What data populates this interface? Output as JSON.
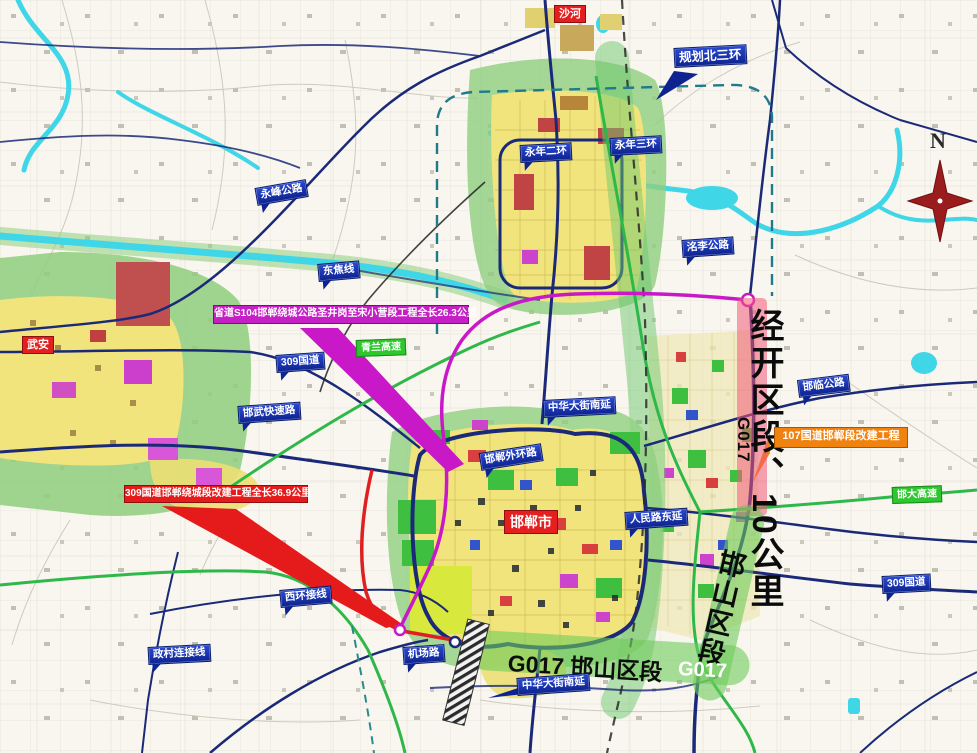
{
  "map": {
    "city_labels": {
      "shahe": "沙河",
      "wuan": "武安",
      "handan": "邯郸市"
    },
    "road_labels": {
      "yongfeng": "永峰公路",
      "dongjiao": "东焦线",
      "g309_west": "309国道",
      "hanwu": "邯武快速路",
      "mingli": "洺李公路",
      "yongnian_2nd_ring": "永年二环",
      "yongnian_3rd_ring": "永年三环",
      "planned_north_3rd_ring": "规划北三环",
      "zhonghua_south_ext_n": "中华大街南延",
      "handan_outer_ring": "邯郸外环路",
      "renmin_east_ext": "人民路东延",
      "hanlin": "邯临公路",
      "g309_east": "309国道",
      "xihuan_connector": "西环接线",
      "zhengcun_connector": "政村连接线",
      "airport_road": "机场路",
      "zhonghua_south_ext_s": "中华大街南延"
    },
    "expressway_labels": {
      "qinglan": "青兰高速",
      "handa": "邯大高速"
    },
    "project_banners": {
      "s104": "省道S104邯郸绕城公路圣井岗至宋小营段工程全长26.3公里",
      "g309": "309国道邯郸绕城段改建工程全长36.9公里",
      "g107": "107国道邯郸段改建工程"
    },
    "section_marks": {
      "jingkai": "经开区段、10公里",
      "g017_side": "G017",
      "hanshan_side": "邯山区段",
      "bottom_band": "G017 邯山区段",
      "g017_band_end": "G017"
    },
    "compass": {
      "north": "N"
    },
    "colors": {
      "road_label_bg": "#1431b8",
      "city_label_bg": "#e31f1f",
      "expressway_label_bg": "#2ec82e",
      "s104_banner": "#c520c5",
      "g309_banner": "#e51b1b",
      "g107_banner": "#f0820f",
      "jingkai_band": "#f06a86",
      "hanshan_band": "#6ecb5e",
      "urban_fill": "#f2e47c",
      "water": "#3fd6e8",
      "navy_road": "#1b2a78",
      "expressway_green": "#2eb84a",
      "s104_route": "#c818c8",
      "g309_route": "#e02020"
    }
  }
}
